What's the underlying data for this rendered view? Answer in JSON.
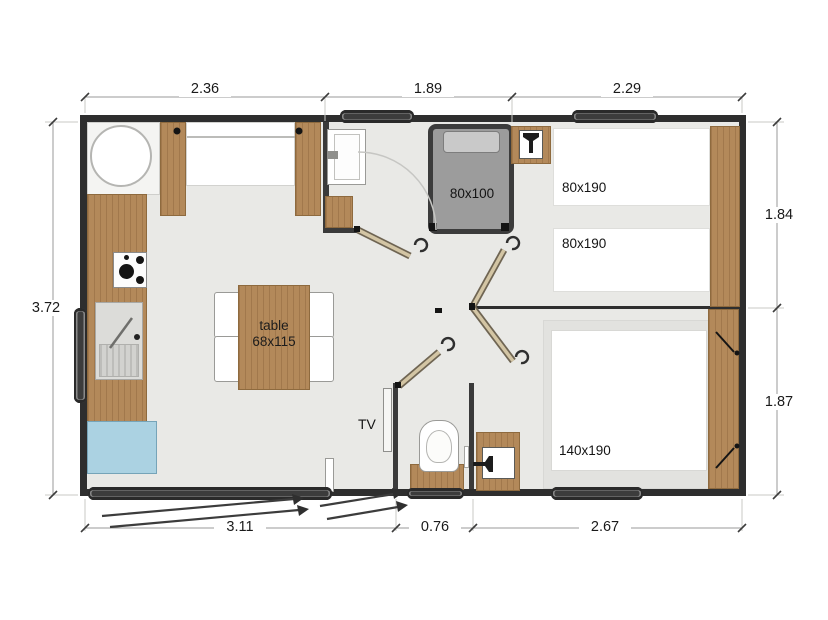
{
  "plan": {
    "type": "floor-plan",
    "units": "meters (dimensions), centimeters (furniture sizes)"
  },
  "dims": {
    "top": [
      "2.36",
      "1.89",
      "2.29"
    ],
    "left": [
      "3.72"
    ],
    "right": [
      "1.84",
      "1.87"
    ],
    "bottom": [
      "3.11",
      "0.76",
      "2.67"
    ]
  },
  "rooms": {
    "bathroom": {
      "shower_label": "80x100"
    },
    "twin_bedroom": {
      "bed1_label": "80x190",
      "bed2_label": "80x190"
    },
    "double_bedroom": {
      "bed_label": "140x190"
    },
    "living": {
      "table_word": "table",
      "table_size": "68x115",
      "tv_label": "TV"
    }
  },
  "icons": {
    "stove-icon": "4 black burner circles",
    "kitchen-sink-icon": "basin with drainer stripes and tap",
    "round-basin-icon": "white circle in corner unit",
    "washbasin-tap-icon": "tap glyph in white square",
    "toilet-icon": "toilet bowl on wooden base",
    "shower-icon": "gray stall with tray",
    "door-icon": "beige leaf with hook handle",
    "window-icon": "dark rounded pill in wall",
    "steps-icon": "diagonal double lines with arrows"
  },
  "colors": {
    "wall": "#2e2e2e",
    "floor": "#e9e9e6",
    "wood": "#b3895a",
    "shower": "#9c9c9c",
    "fridge_blue": "#abd2e2",
    "dimension_text": "#1a1a1a"
  }
}
